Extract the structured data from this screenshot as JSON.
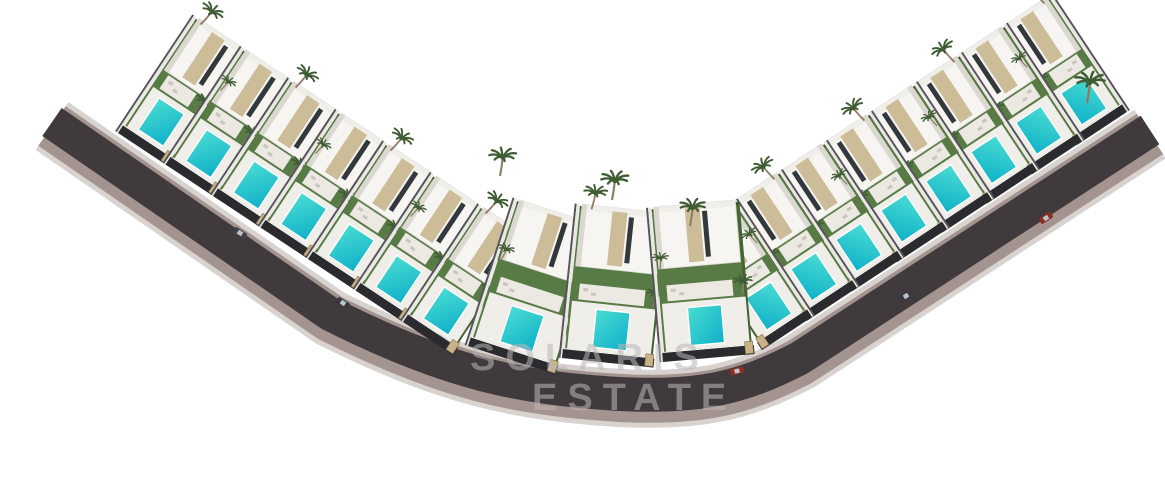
{
  "image": {
    "description": "Aerial 3D architectural rendering of a resort development of modern white villas with private turquoise pools and palm trees, arranged in two mirrored rows along a dark curved access road on a white background",
    "background_color": "#ffffff"
  },
  "watermark": {
    "line1": "SOLARIS",
    "line2": "ESTATE",
    "color": "#bcb6b8"
  },
  "development": {
    "rows": {
      "left": {
        "villa_count": 7
      },
      "center": {
        "villa_count": 3
      },
      "right": {
        "villa_count": 8
      }
    },
    "cars": [
      {
        "color_name": "dark-gray",
        "hex": "#3a3740"
      },
      {
        "color_name": "dark-gray",
        "hex": "#45414a"
      },
      {
        "color_name": "red",
        "hex": "#8e2d22"
      },
      {
        "color_name": "dark-gray",
        "hex": "#3a3740"
      },
      {
        "color_name": "red",
        "hex": "#8e2d22"
      }
    ],
    "colors": {
      "asphalt": "#413a3d",
      "curb": "#a3948f",
      "sidewalk": "#d9d3d0",
      "pool_light": "#49dcd2",
      "pool_deep": "#0fb0c8",
      "lawn": "#587a45",
      "lawn_dark": "#3e5a2e",
      "villa_white": "#f6f5f1",
      "villa_shade": "#dbd8d1",
      "roof_light": "#efeee9",
      "stone": "#cdbc98",
      "glass": "#33383d",
      "deck": "#f0eee8",
      "terrace": "#ece9e2",
      "fence": "#2b2a2e",
      "pillar": "#c8b389",
      "palm_green": "#3f5c33",
      "palm_trunk": "#8d7d66",
      "divider_light": "#eae8e2",
      "divider_dark": "#56535b"
    }
  }
}
